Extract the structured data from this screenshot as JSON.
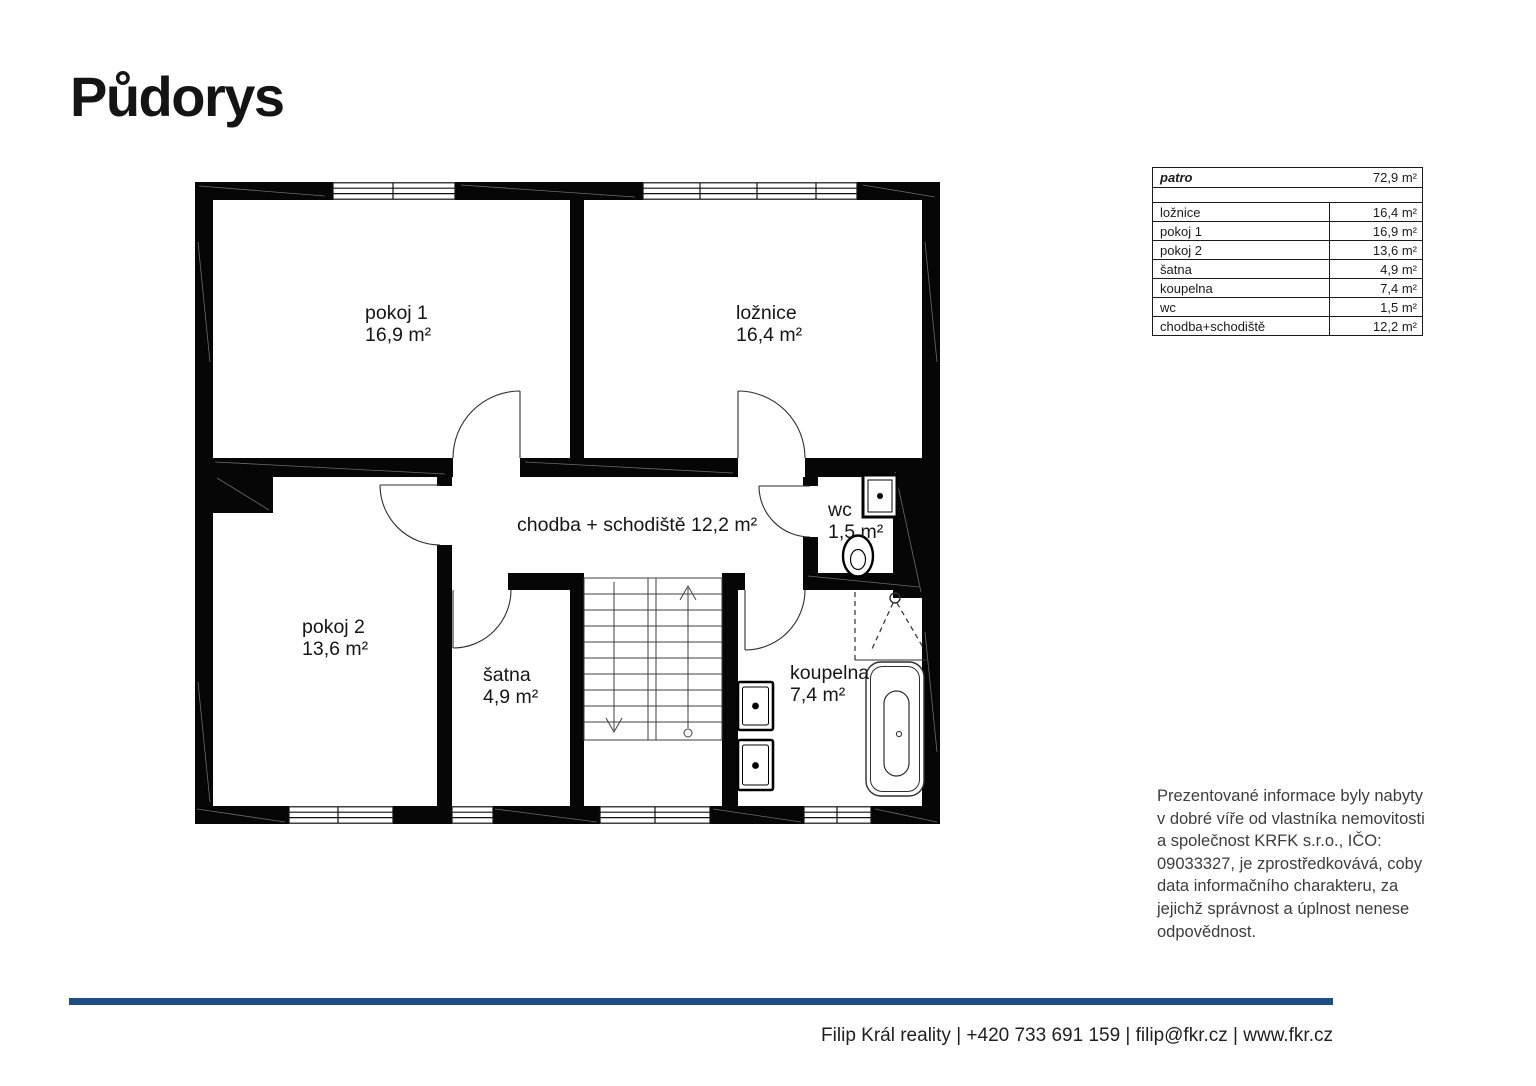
{
  "title": "Půdorys",
  "plan": {
    "rooms": [
      {
        "id": "pokoj1",
        "name": "pokoj 1",
        "area": "16,9 m²"
      },
      {
        "id": "loznice",
        "name": "ložnice",
        "area": "16,4 m²"
      },
      {
        "id": "pokoj2",
        "name": "pokoj 2",
        "area": "13,6 m²"
      },
      {
        "id": "satna",
        "name": "šatna",
        "area": "4,9 m²"
      },
      {
        "id": "koupelna",
        "name": "koupelna",
        "area": "7,4 m²"
      },
      {
        "id": "wc",
        "name": "wc",
        "area": "1,5 m²"
      }
    ],
    "hall_label": "chodba + schodiště 12,2 m²"
  },
  "table": {
    "header": {
      "name": "patro",
      "value": "72,9 m²"
    },
    "rows": [
      {
        "name": "ložnice",
        "value": "16,4 m²"
      },
      {
        "name": "pokoj 1",
        "value": "16,9 m²"
      },
      {
        "name": "pokoj 2",
        "value": "13,6 m²"
      },
      {
        "name": "šatna",
        "value": "4,9 m²"
      },
      {
        "name": "koupelna",
        "value": "7,4 m²"
      },
      {
        "name": "wc",
        "value": "1,5 m²"
      },
      {
        "name": "chodba+schodiště",
        "value": "12,2 m²"
      }
    ]
  },
  "disclaimer": {
    "lines": [
      "Prezentované informace byly nabyty",
      "v dobré víře od vlastníka nemovitosti",
      "a společnost KRFK s.r.o., IČO:",
      "09033327, je zprostředkovává, coby",
      "data informačního charakteru, za",
      "jejichž správnost a úplnost nenese",
      "odpovědnost."
    ]
  },
  "footer": {
    "text": "Filip Král reality | +420 733 691 159 | filip@fkr.cz | www.fkr.cz"
  },
  "colors": {
    "accent": "#1d4e89",
    "wall": "#060606",
    "text": "#1a1a1a"
  }
}
